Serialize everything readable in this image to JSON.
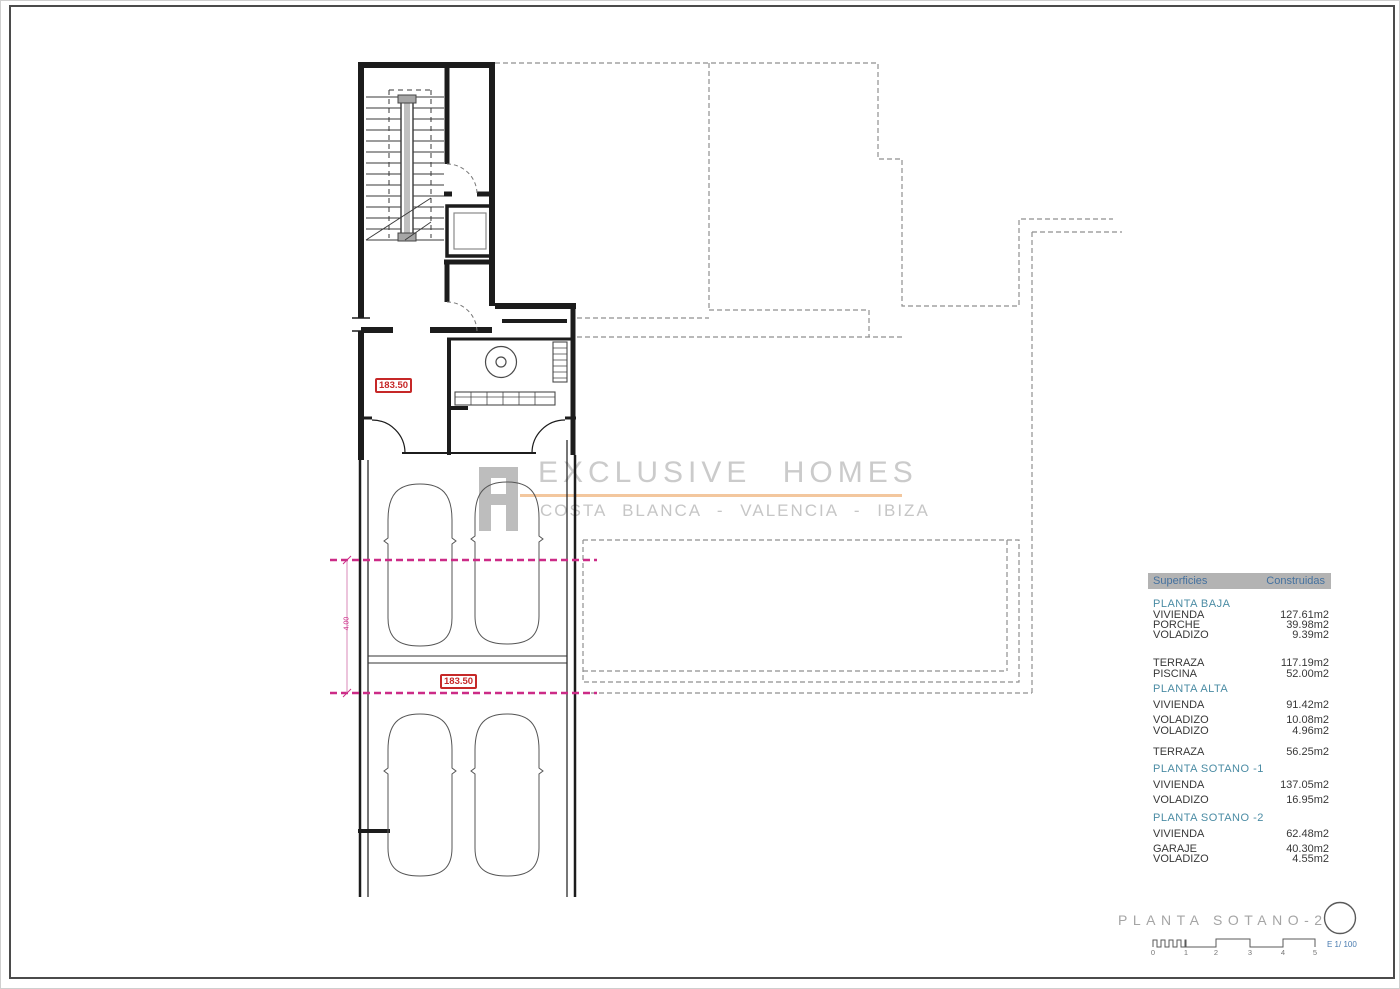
{
  "plan": {
    "level_labels": [
      {
        "text": "183.50"
      },
      {
        "text": "183.50"
      }
    ],
    "dimension_label": "4.00",
    "colors": {
      "wall": "#1c1c1c",
      "dashed_boundary": "#8f8f8f",
      "magenta": "#cc2b87",
      "red_label": "#c62828"
    }
  },
  "watermark": {
    "brand": "EXCLUSIVE HOMES",
    "locations": "COSTA BLANCA - VALENCIA - IBIZA",
    "accent_color": "#f3c79e",
    "text_color": "#cbcbcb"
  },
  "area_table": {
    "header": {
      "col1": "Superficies",
      "col2": "Construidas"
    },
    "rows": [
      {
        "label": "PLANTA BAJA",
        "value": ""
      },
      {
        "label": "VIVIENDA",
        "value": "127.61m2"
      },
      {
        "label": "PORCHE",
        "value": "39.98m2"
      },
      {
        "label": "VOLADIZO",
        "value": "9.39m2"
      },
      {
        "label": "TERRAZA",
        "value": "117.19m2"
      },
      {
        "label": "PISCINA",
        "value": "52.00m2"
      },
      {
        "label": "PLANTA ALTA",
        "value": ""
      },
      {
        "label": "VIVIENDA",
        "value": "91.42m2"
      },
      {
        "label": "VOLADIZO",
        "value": "10.08m2"
      },
      {
        "label": "VOLADIZO",
        "value": "4.96m2"
      },
      {
        "label": "TERRAZA",
        "value": "56.25m2"
      },
      {
        "label": "PLANTA SOTANO -1",
        "value": ""
      },
      {
        "label": "VIVIENDA",
        "value": "137.05m2"
      },
      {
        "label": "VOLADIZO",
        "value": "16.95m2"
      },
      {
        "label": "PLANTA SOTANO -2",
        "value": ""
      },
      {
        "label": "VIVIENDA",
        "value": "62.48m2"
      },
      {
        "label": "GARAJE",
        "value": "40.30m2"
      },
      {
        "label": "VOLADIZO",
        "value": "4.55m2"
      }
    ]
  },
  "title_block": {
    "title": "PLANTA SOTANO-2",
    "scale_label": "E 1/ 100",
    "scale_ticks": [
      "0",
      "1",
      "2",
      "3",
      "4",
      "5"
    ]
  }
}
